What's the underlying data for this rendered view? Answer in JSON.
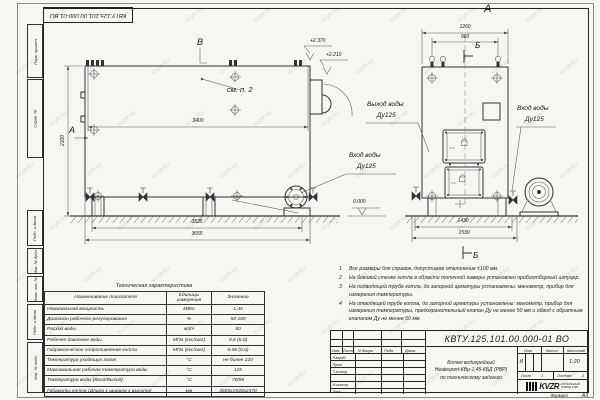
{
  "sheet": {
    "watermark": "KVZR.RU",
    "doc_number_top": "КВТУ.125.101.00.000-01  ВО",
    "format_label": "Формат",
    "format_value": "А3"
  },
  "margin_stamps": [
    "Перв. примен.",
    "Справ. №",
    "Подп. и дата",
    "Инв. № дубл.",
    "Взам. инв. №",
    "Подп. и дата",
    "Инв. № подл."
  ],
  "left_view": {
    "marker_b": "В",
    "marker_a": "А",
    "see_note": "см. п. 2",
    "dim_length_top": "3400",
    "dim_height": "2300",
    "dim_base": "3535",
    "dim_overall": "3655",
    "elev_top": "+2.370",
    "elev_mid": "+2.210",
    "elev_zero": "0.000",
    "inlet_label": "Вход воды",
    "inlet_dn": "Ду125"
  },
  "front_view": {
    "title": "А",
    "dim_width_top": "1260",
    "dim_lugs": "960",
    "marker_b_top": "Б",
    "marker_b_bottom": "Б",
    "outlet_label": "Выход воды",
    "outlet_dn": "Ду125",
    "inlet_label": "Вход воды",
    "inlet_dn": "Ду125",
    "dim_base": "1430",
    "dim_overall": "1530"
  },
  "notes": [
    {
      "num": "1",
      "text": "Все размеры для справок, допустимое отклонение ±100 мм."
    },
    {
      "num": "2",
      "text": "На боковой стенке котла в области топочной камеры установлен пробоотборный штуцер."
    },
    {
      "num": "3",
      "text": "На  подводящей трубе котла, до запорной арматуры установлены:  манометр, прибор для измерения температуры."
    },
    {
      "num": "4",
      "text": "На отводящей трубе котла, до запорной арматуры установлены:  манометр, прибор для измерения температуры, предохранительный клапан  Ду не менее 50 мм и обвод с обратным клапаном  Ду не менее 50 мм."
    }
  ],
  "tech_table": {
    "title": "Техническая характеристика",
    "col_name": "Наименование показателя",
    "col_unit": "Единицы измерения",
    "col_value": "Значение",
    "rows": [
      {
        "name": "Номинальная мощность",
        "unit": "МВт",
        "value": "1,45"
      },
      {
        "name": "Диапазон рабочего регулирования",
        "unit": "%",
        "value": "50-100"
      },
      {
        "name": "Расход воды",
        "unit": "м3/ч",
        "value": "50"
      },
      {
        "name": "Рабочее давление воды",
        "unit": "МПа (кгс/см2)",
        "value": "0,6 (6,0)"
      },
      {
        "name": "Гидравлическое сопротивление котла",
        "unit": "МПа (кгс/см2)",
        "value": "0,06 (0,6)"
      },
      {
        "name": "Температура уходящих газов",
        "unit": "°С",
        "value": "не более 220"
      },
      {
        "name": "Максимальная рабочая температура воды",
        "unit": "°С",
        "value": "115"
      },
      {
        "name": "Температура воды (Вход/Выход)",
        "unit": "°С",
        "value": "70/95"
      },
      {
        "name": "Габариты котла (Длина х ширина х высота)",
        "unit": "мм",
        "value": "3655х1530х2370"
      }
    ]
  },
  "title_block": {
    "doc_number": "КВТУ.125.101.00.000-01  ВО",
    "col_izm": "Изм.",
    "col_list": "Лист",
    "col_dokum": "N докум.",
    "col_podp": "Подп.",
    "col_data": "Дата",
    "row_razrab": "Разраб.",
    "row_prov": "Пров.",
    "row_tkontr": "Т.контр.",
    "row_nkontr": "Н.контр.",
    "row_utv": "Утв.",
    "name_line1": "Котел водогрейный",
    "name_line2": "Heatexpert-КВр-1,45-КБД (РВР)",
    "name_line3": "по техническому заданию",
    "lit_header": "Лит.",
    "mass_header": "Масса",
    "scale_header": "Масштаб",
    "lit_value": "И",
    "scale_value": "1:20",
    "sheet_label": "Лист",
    "sheet_value": "1",
    "sheets_label": "Листов",
    "sheets_value": "2",
    "logo_text": "KVZR",
    "logo_sub1": "КОТЕЛЬНЫЙ",
    "logo_sub2": "ЗАВОД РЭП"
  }
}
